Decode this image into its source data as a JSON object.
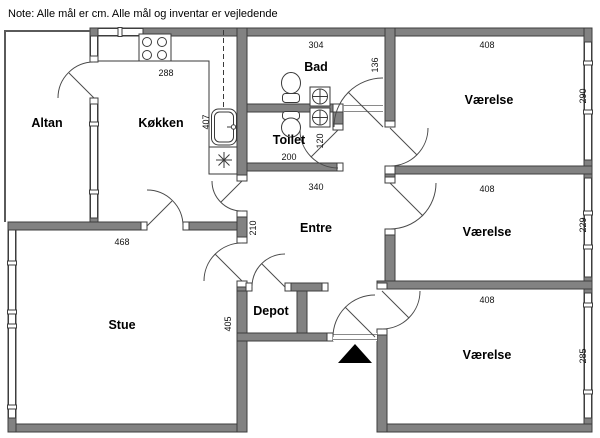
{
  "note": "Note: Alle mål er cm. Alle mål og inventar er vejledende",
  "units": "cm",
  "rooms": {
    "altan": {
      "label": "Altan"
    },
    "kokken": {
      "label": "Køkken",
      "width": "288",
      "depth": "407"
    },
    "bad": {
      "label": "Bad",
      "width": "304",
      "side": "136"
    },
    "toilet": {
      "label": "Toilet",
      "width": "200",
      "side": "120"
    },
    "entre": {
      "label": "Entre",
      "width": "340",
      "side": "210"
    },
    "stue": {
      "label": "Stue",
      "width": "468",
      "depth": "405"
    },
    "depot": {
      "label": "Depot"
    },
    "vaerelse_top": {
      "label": "Værelse",
      "width": "408",
      "depth": "290"
    },
    "vaerelse_mid": {
      "label": "Værelse",
      "width": "408",
      "depth": "229"
    },
    "vaerelse_bot": {
      "label": "Værelse",
      "width": "408",
      "depth": "285"
    }
  },
  "colors": {
    "wall_fill": "#828282",
    "wall_stroke": "#3d3d3d",
    "background": "#ffffff",
    "text": "#000000",
    "entrance_marker": "#000000"
  }
}
